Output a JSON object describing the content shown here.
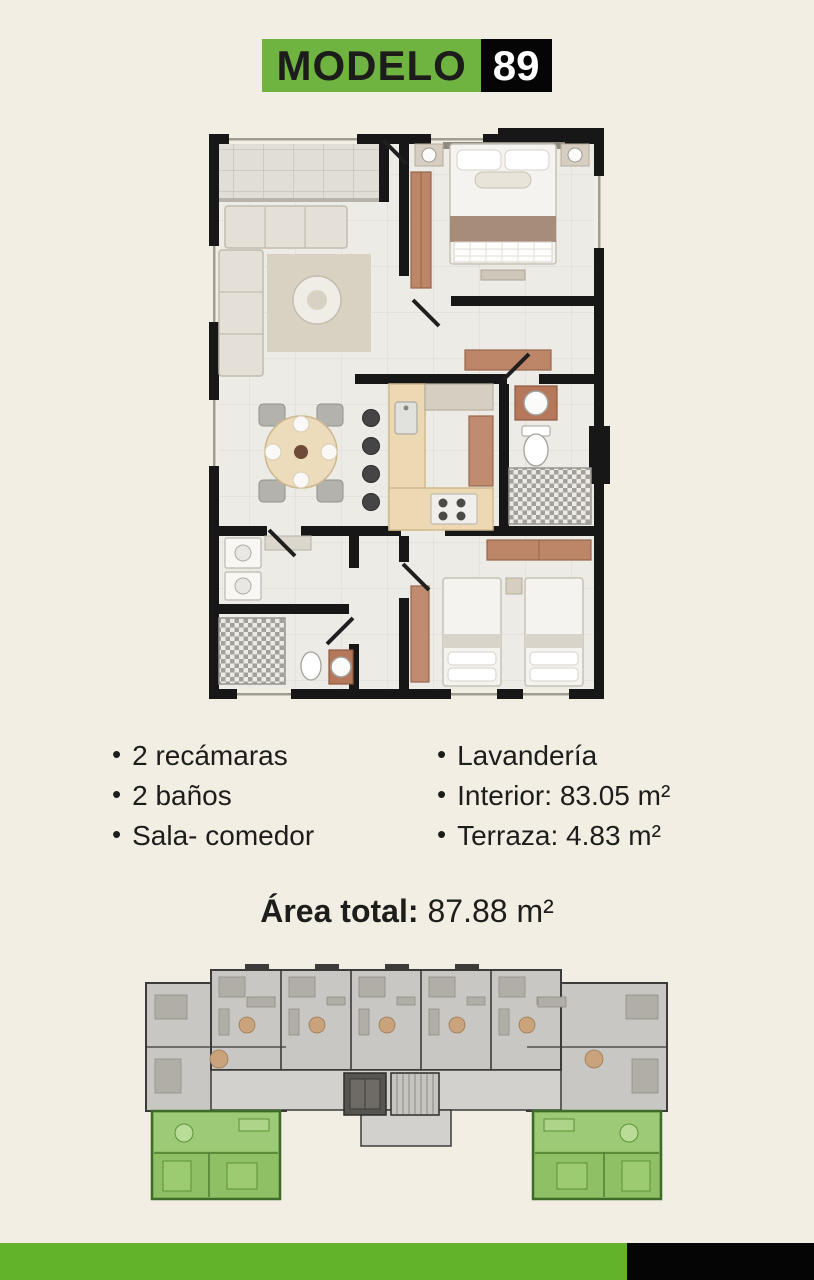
{
  "meta": {
    "background_color": "#f2eee3",
    "title_green": "#6fb440",
    "strip_green": "#62b22a",
    "black": "#050505",
    "wall_color": "#171717",
    "wood_accent": "#bd8668",
    "highlight_unit_green": "#8fc065"
  },
  "header": {
    "model_label": "MODELO",
    "model_number": "89"
  },
  "features": {
    "left": [
      "2 recámaras",
      "2 baños",
      "Sala- comedor"
    ],
    "right": [
      "Lavandería",
      "Interior: 83.05 m²",
      "Terraza: 4.83 m²"
    ]
  },
  "total": {
    "label": "Área total:",
    "value": "87.88 m²"
  }
}
